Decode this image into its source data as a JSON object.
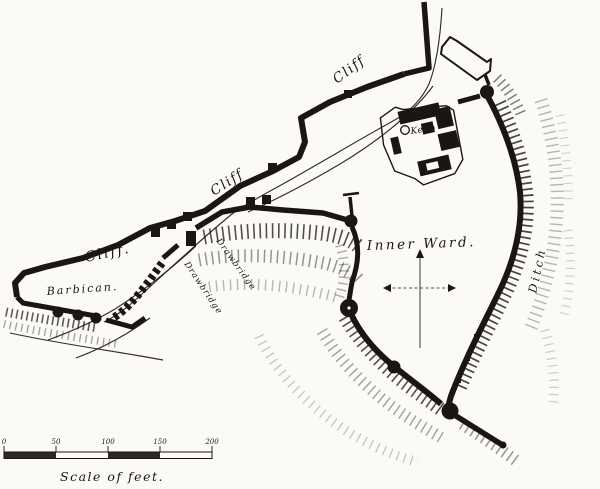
{
  "colors": {
    "ink": "#191613",
    "paper": "#fbfaf6"
  },
  "labels": {
    "cliff_top": "Cliff",
    "cliff_middle": "Cliff",
    "cliff_lower": "Cliff.",
    "barbican": "Barbican.",
    "drawbridge_upper": "Drawbridge",
    "drawbridge_lower": "Drawbridge",
    "keep": "Keep",
    "inner_ward": "Inner Ward.",
    "ditch": "Ditch"
  },
  "scale_bar": {
    "ticks": [
      "0",
      "50",
      "100",
      "150",
      "200"
    ],
    "caption": "Scale of feet."
  }
}
